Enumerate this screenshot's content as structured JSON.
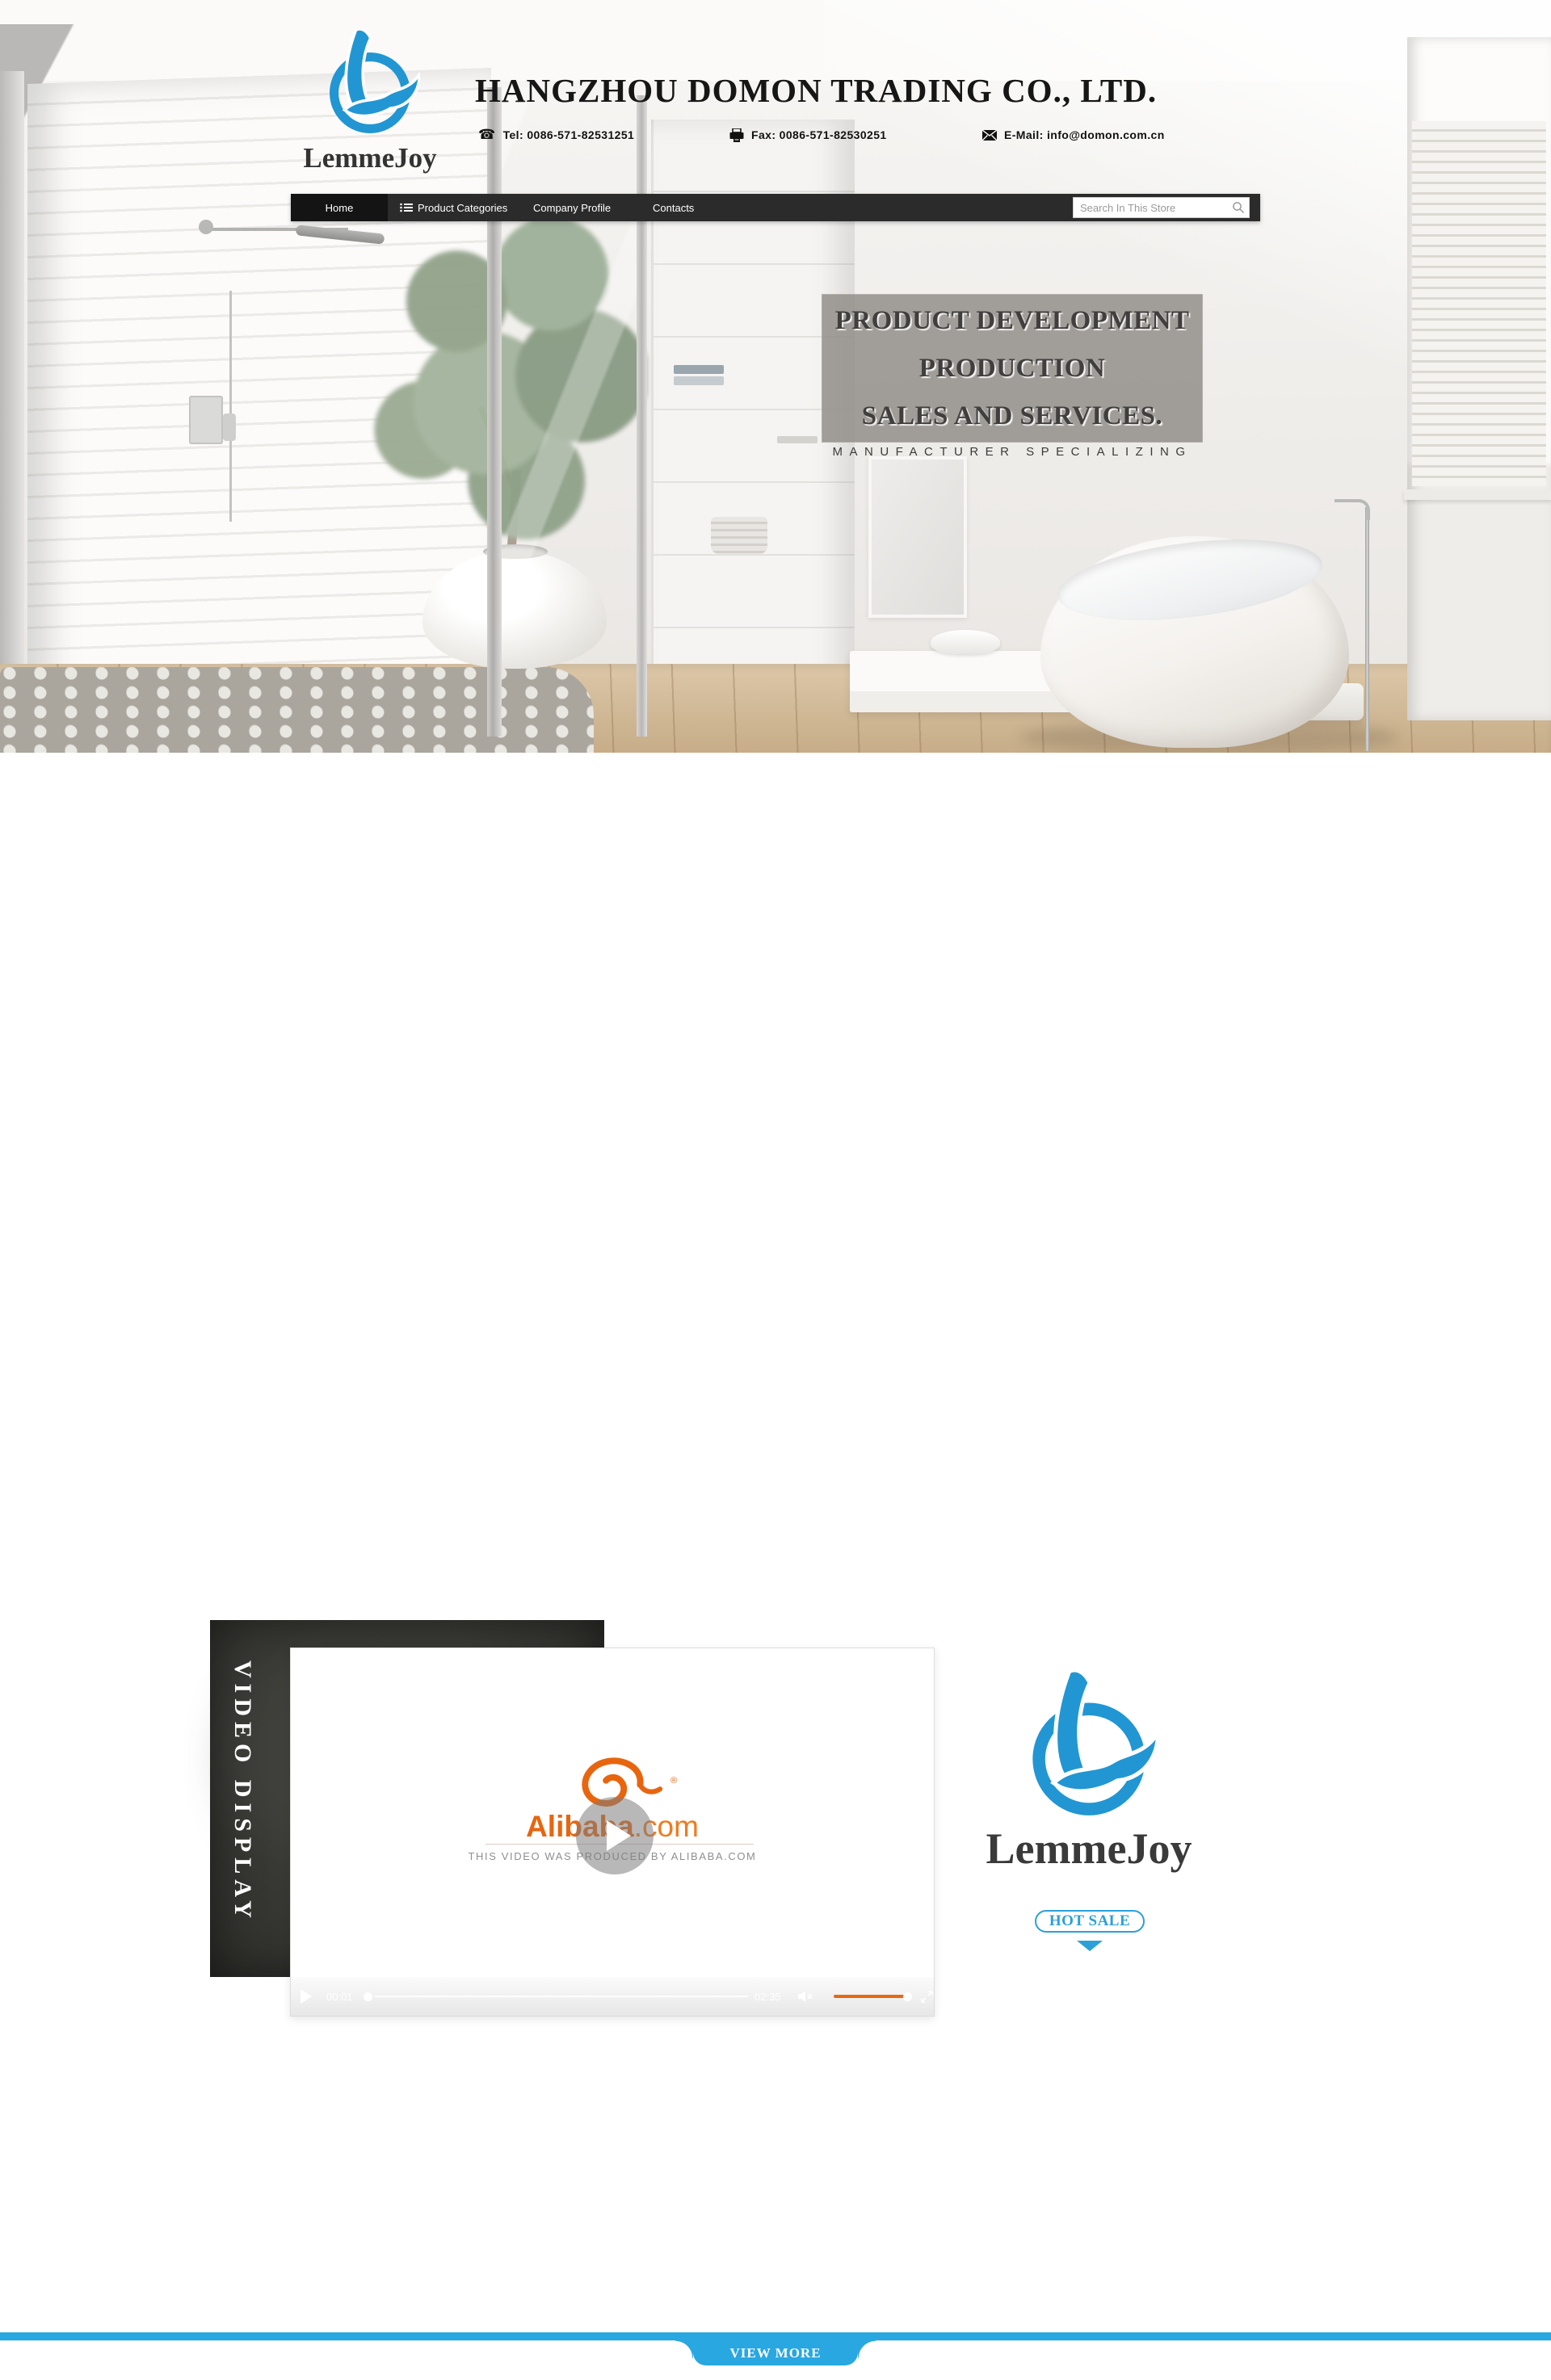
{
  "header": {
    "brand": "LemmeJoy",
    "company_name": "HANGZHOU DOMON TRADING CO., LTD.",
    "tel": "Tel: 0086-571-82531251",
    "fax": "Fax: 0086-571-82530251",
    "email": "E-Mail: info@domon.com.cn"
  },
  "nav": {
    "items": [
      {
        "label": "Home",
        "active": true
      },
      {
        "label": "Product Categories",
        "active": false
      },
      {
        "label": "Company Profile",
        "active": false
      },
      {
        "label": "Contacts",
        "active": false
      }
    ],
    "search_placeholder": "Search In This Store"
  },
  "hero": {
    "headline_line1": "PRODUCT DEVELOPMENT",
    "headline_line2": "PRODUCTION",
    "headline_line3": "SALES AND SERVICES.",
    "tagline": "MANUFACTURER SPECIALIZING"
  },
  "video_section": {
    "banner_title": "VIDEO DISPLAY",
    "player": {
      "brand_bold": "Alibaba",
      "brand_suffix": ".com",
      "registered_mark": "®",
      "caption": "THIS VIDEO WAS PRODUCED BY ALIBABA.COM",
      "current_time": "00:01",
      "duration": "02:35"
    },
    "brand": {
      "name": "LemmeJoy",
      "hot_sale_label": "HOT SALE"
    }
  },
  "footer": {
    "view_more_label": "VIEW MORE"
  },
  "colors": {
    "logo_blue": "#2196d3",
    "accent_blue": "#29a7e1",
    "alibaba_orange": "#e8650f",
    "nav_bg": "#2b2b2b",
    "banner_dark": "#2c2c29"
  }
}
